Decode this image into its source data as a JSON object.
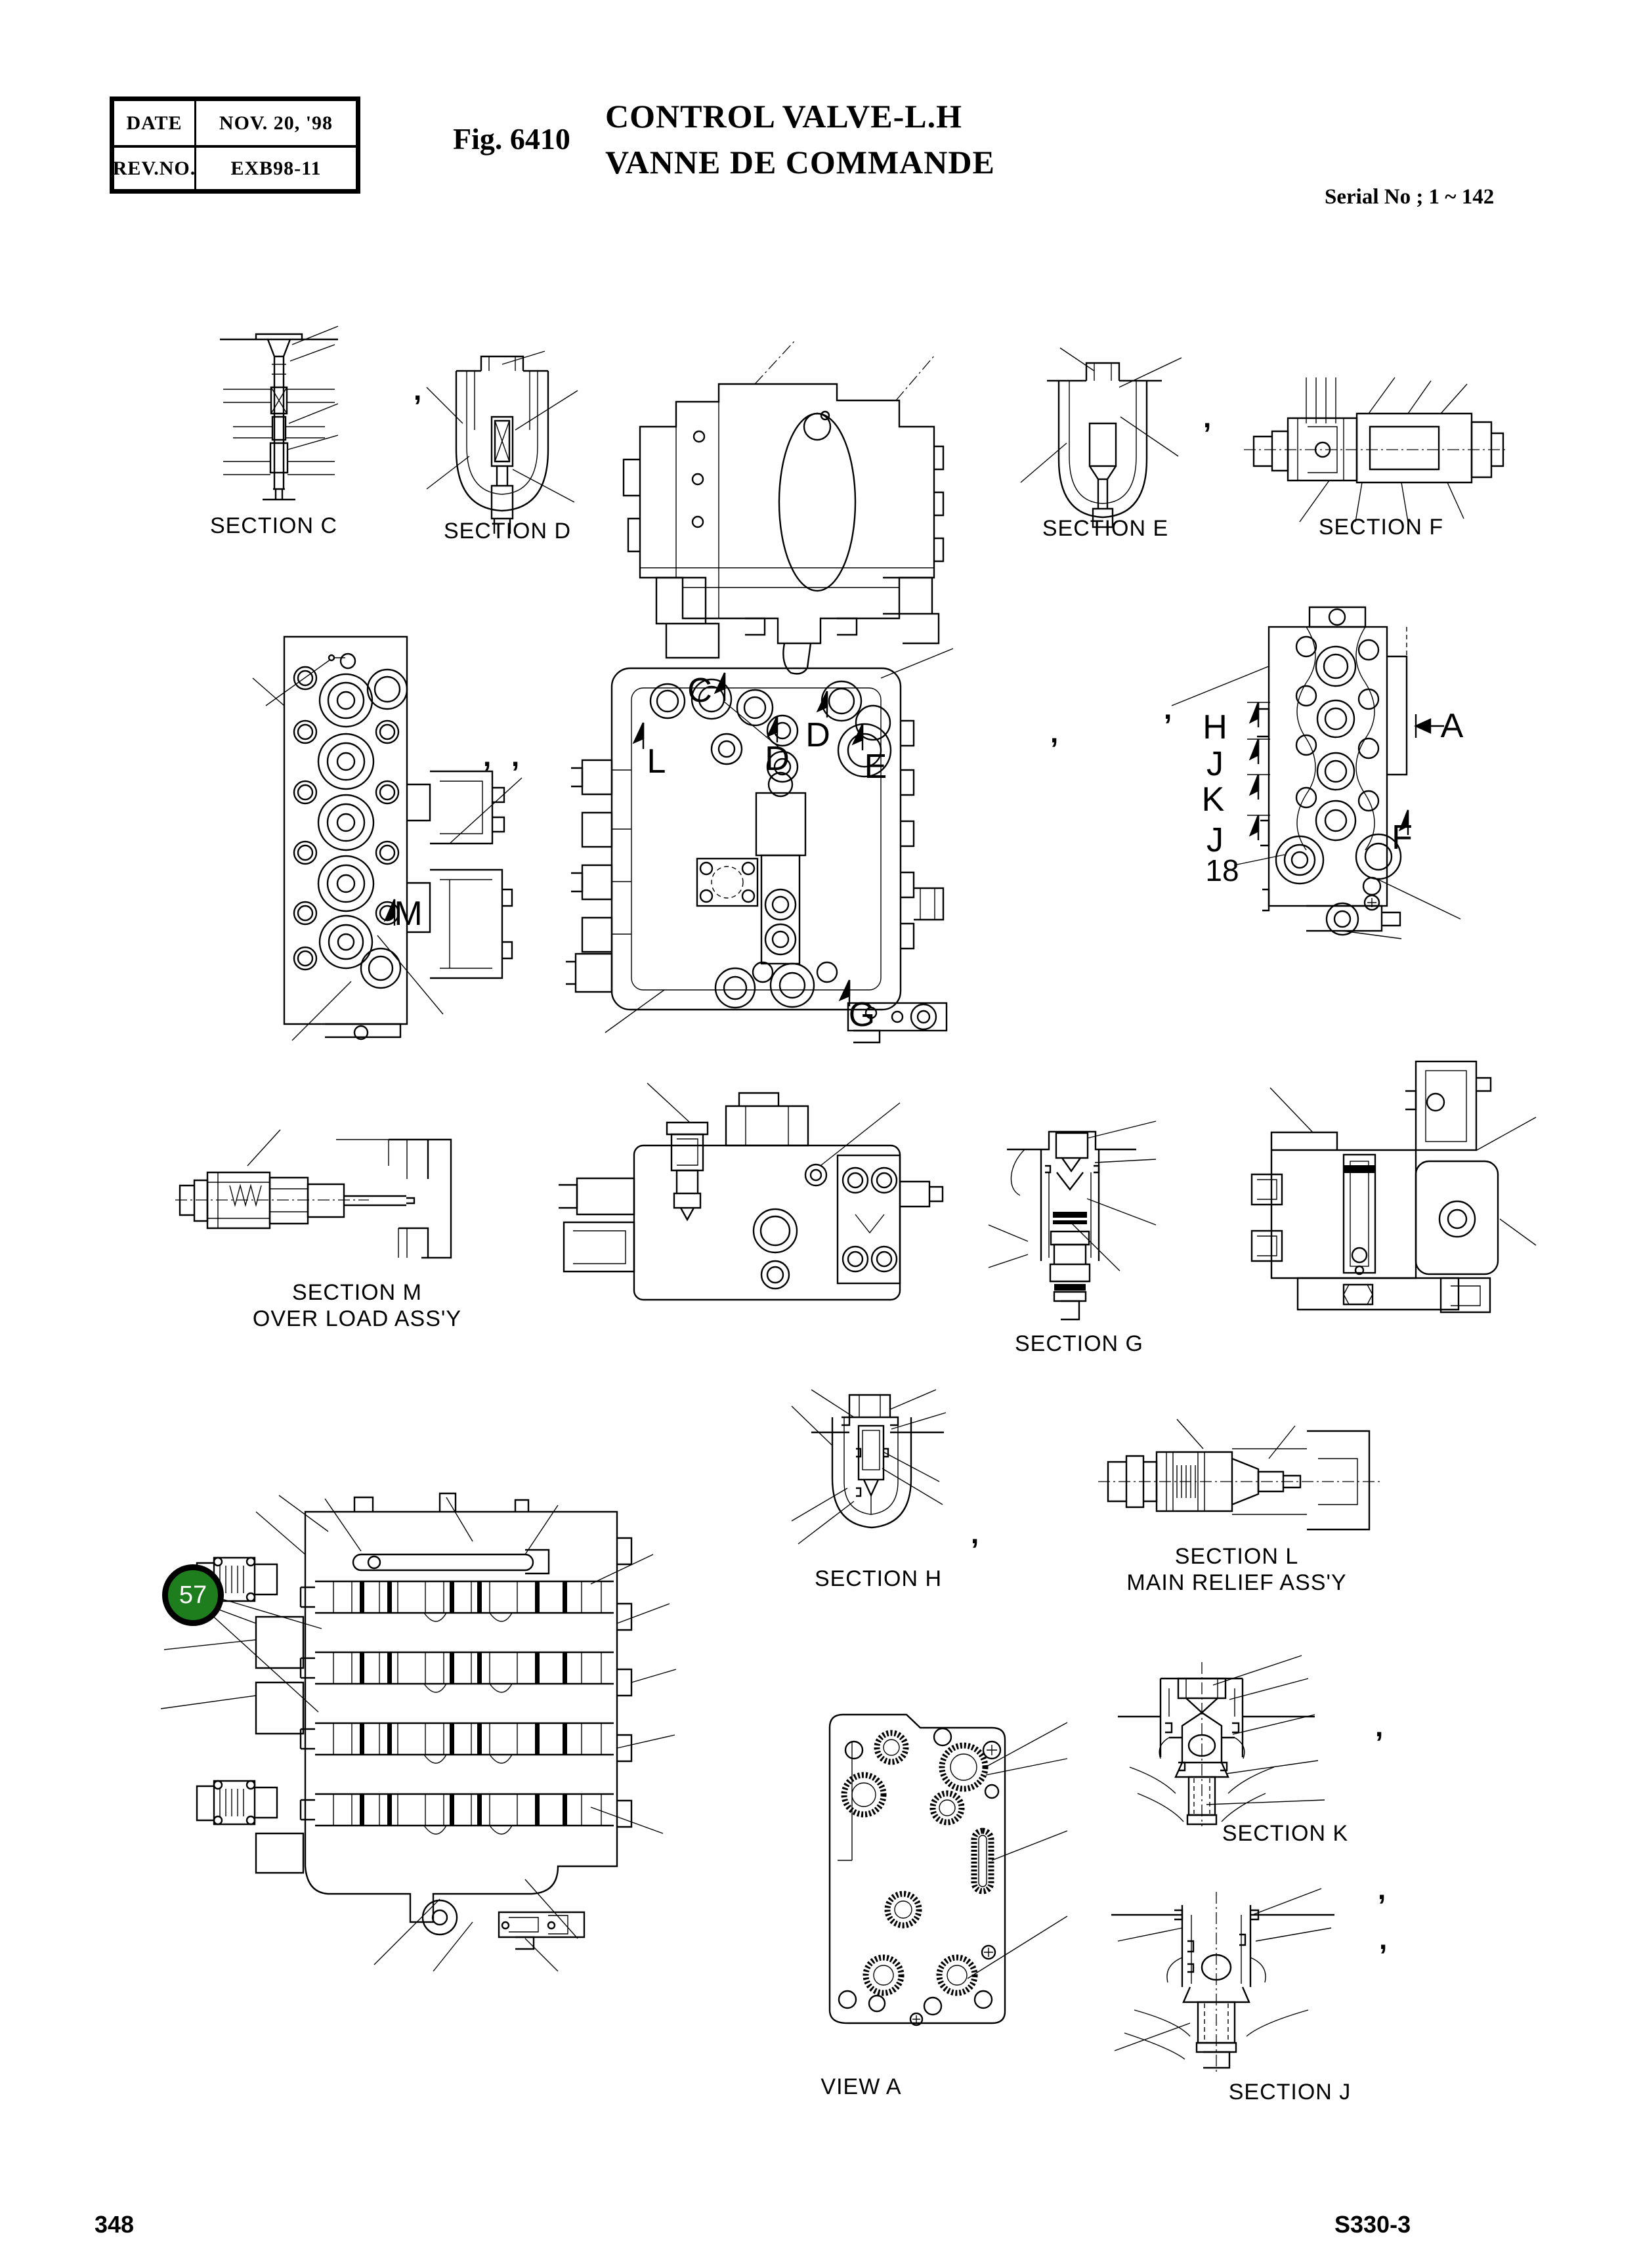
{
  "header": {
    "table": {
      "date_label": "DATE",
      "date_value": "NOV. 20, '98",
      "rev_label": "REV.NO.",
      "rev_value": "EXB98-11"
    },
    "fig": "Fig. 6410",
    "title_en": "CONTROL VALVE-L.H",
    "title_fr": "VANNE DE COMMANDE",
    "serial": "Serial No ; 1 ~ 142"
  },
  "sections": {
    "c": "SECTION C",
    "d": "SECTION D",
    "e": "SECTION E",
    "f": "SECTION F",
    "m": "SECTION M",
    "m_sub": "OVER LOAD ASS'Y",
    "g": "SECTION G",
    "h": "SECTION H",
    "l": "SECTION L",
    "l_sub": "MAIN RELIEF ASS'Y",
    "k": "SECTION K",
    "view_a": "VIEW A",
    "j": "SECTION J"
  },
  "callouts": {
    "m": "M",
    "c": "C",
    "l": "L",
    "d1": "D",
    "d2": "D",
    "e": "E",
    "g": "G",
    "h": "H",
    "j1": "J",
    "k": "K",
    "j2": "J",
    "part_18": "18",
    "a": "A",
    "f": "F"
  },
  "balloon": {
    "number": "57",
    "fill_color": "#1e7e1e"
  },
  "marks": {
    "comma": ","
  },
  "footer": {
    "page_number": "348",
    "doc_number": "S330-3"
  }
}
